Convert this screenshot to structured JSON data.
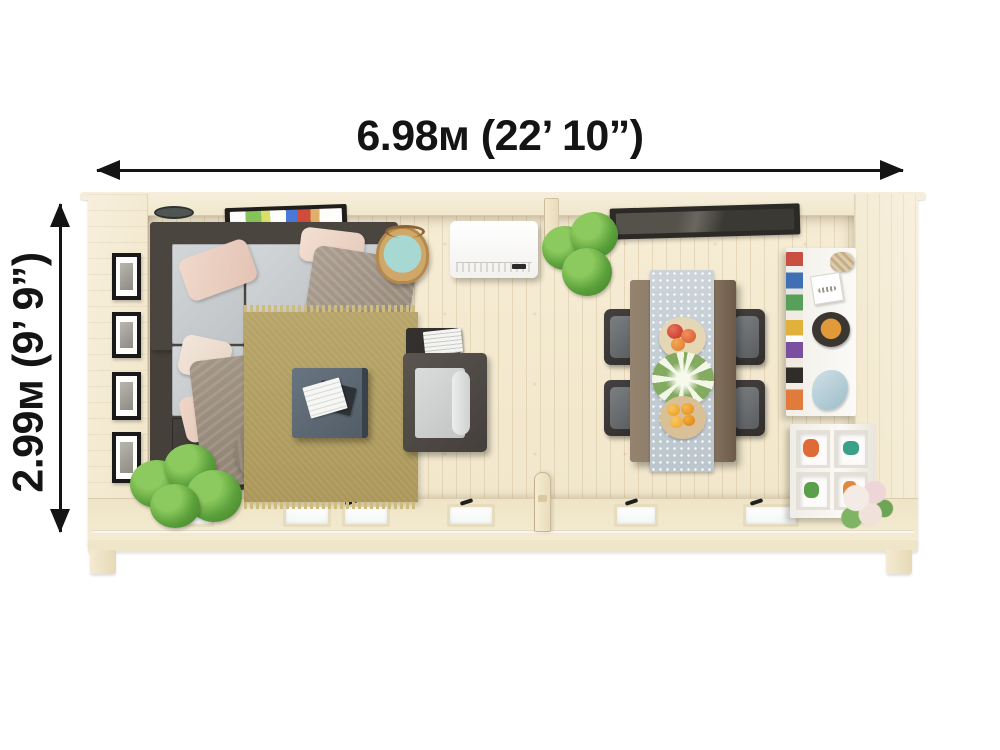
{
  "image_type": "garden-cabin-floor-plan",
  "dimensions": {
    "width_label": "6.98м (22’ 10”)",
    "height_label": "2.99м (9’ 9”)"
  },
  "palette": {
    "background": "#ffffff",
    "dimension_ink": "#141414",
    "floor_wood": "#f4ead2",
    "wall_wood": "#f3ead4",
    "sofa_frame": "#4b4540",
    "sofa_cushion": "#c8cbce",
    "pillow_blush": "#eed6c9",
    "blanket_taupe": "#a49789",
    "rug_tan": "#b3a065",
    "coffee_table_slate": "#5d6873",
    "armchair_dark": "#54504c",
    "dining_table_brown": "#8b7a67",
    "runner_gray_blue": "#c9d1d7",
    "chair_dark": "#3a3734",
    "plant_green": "#5ba03b",
    "rooflight_dark": "#2c2a27",
    "units_white": "#f9f7f3",
    "basket_tan": "#cfa869",
    "basket_blanket_teal": "#a8d8d2"
  },
  "rooms": {
    "living_room": {
      "items": [
        "corner-sofa",
        "throw-pillows",
        "throw-blankets",
        "area-rug",
        "coffee-table",
        "books",
        "armchair",
        "side-table",
        "storage-basket",
        "wall-tv",
        "wall-light",
        "gallery-wall-frames",
        "potted-plant",
        "air-conditioner"
      ]
    },
    "dining_room": {
      "items": [
        "dining-table",
        "table-runner",
        "four-dining-chairs",
        "apple-plate",
        "flower-centerpiece",
        "citrus-bowl",
        "hanging-plant",
        "rooflight",
        "white-shelf-unit",
        "cube-storage",
        "flower-bouquet"
      ]
    }
  },
  "openings": {
    "window_count": 6,
    "door_count": 1
  }
}
